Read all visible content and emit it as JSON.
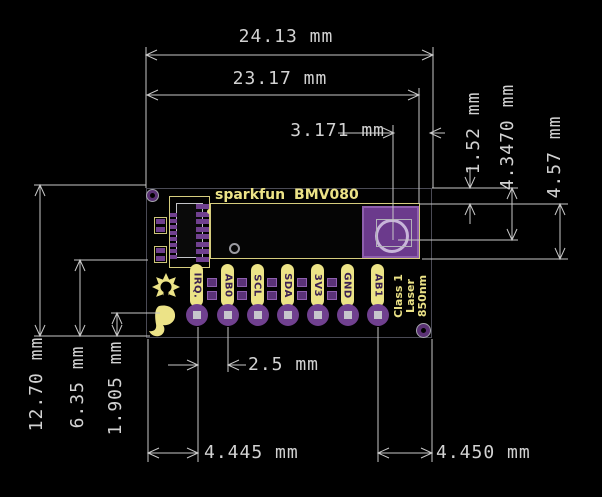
{
  "drawing": {
    "kind": "pcb-dimension-drawing",
    "units": "mm"
  },
  "board": {
    "silkscreen": {
      "brand": "sparkfun",
      "model": "BMV080",
      "pins": [
        "IRQ.",
        "AB0",
        "SCL",
        "SDA",
        "3V3",
        "GND",
        "AB1"
      ],
      "laser_label": [
        "Class 1",
        "Laser",
        "850nm"
      ]
    },
    "colors": {
      "silk_yellow": "#ece387",
      "pad_purple": "#70408f",
      "window_purple": "#6b3a8c",
      "dimension_gray": "#c8c8c8",
      "background": "#000000"
    }
  },
  "dims": {
    "top_outer": "24.13 mm",
    "top_inner": "23.17 mm",
    "window_offset": "3.171 mm",
    "right_small": "1.52 mm",
    "right_mid": "4.3470 mm",
    "right_large": "4.57 mm",
    "left_full": "12.70 mm",
    "left_half": "6.35 mm",
    "left_pad": "1.905 mm",
    "pin_pitch": "2.5 mm",
    "bottom_left": "4.445 mm",
    "bottom_right": "4.450 mm"
  }
}
